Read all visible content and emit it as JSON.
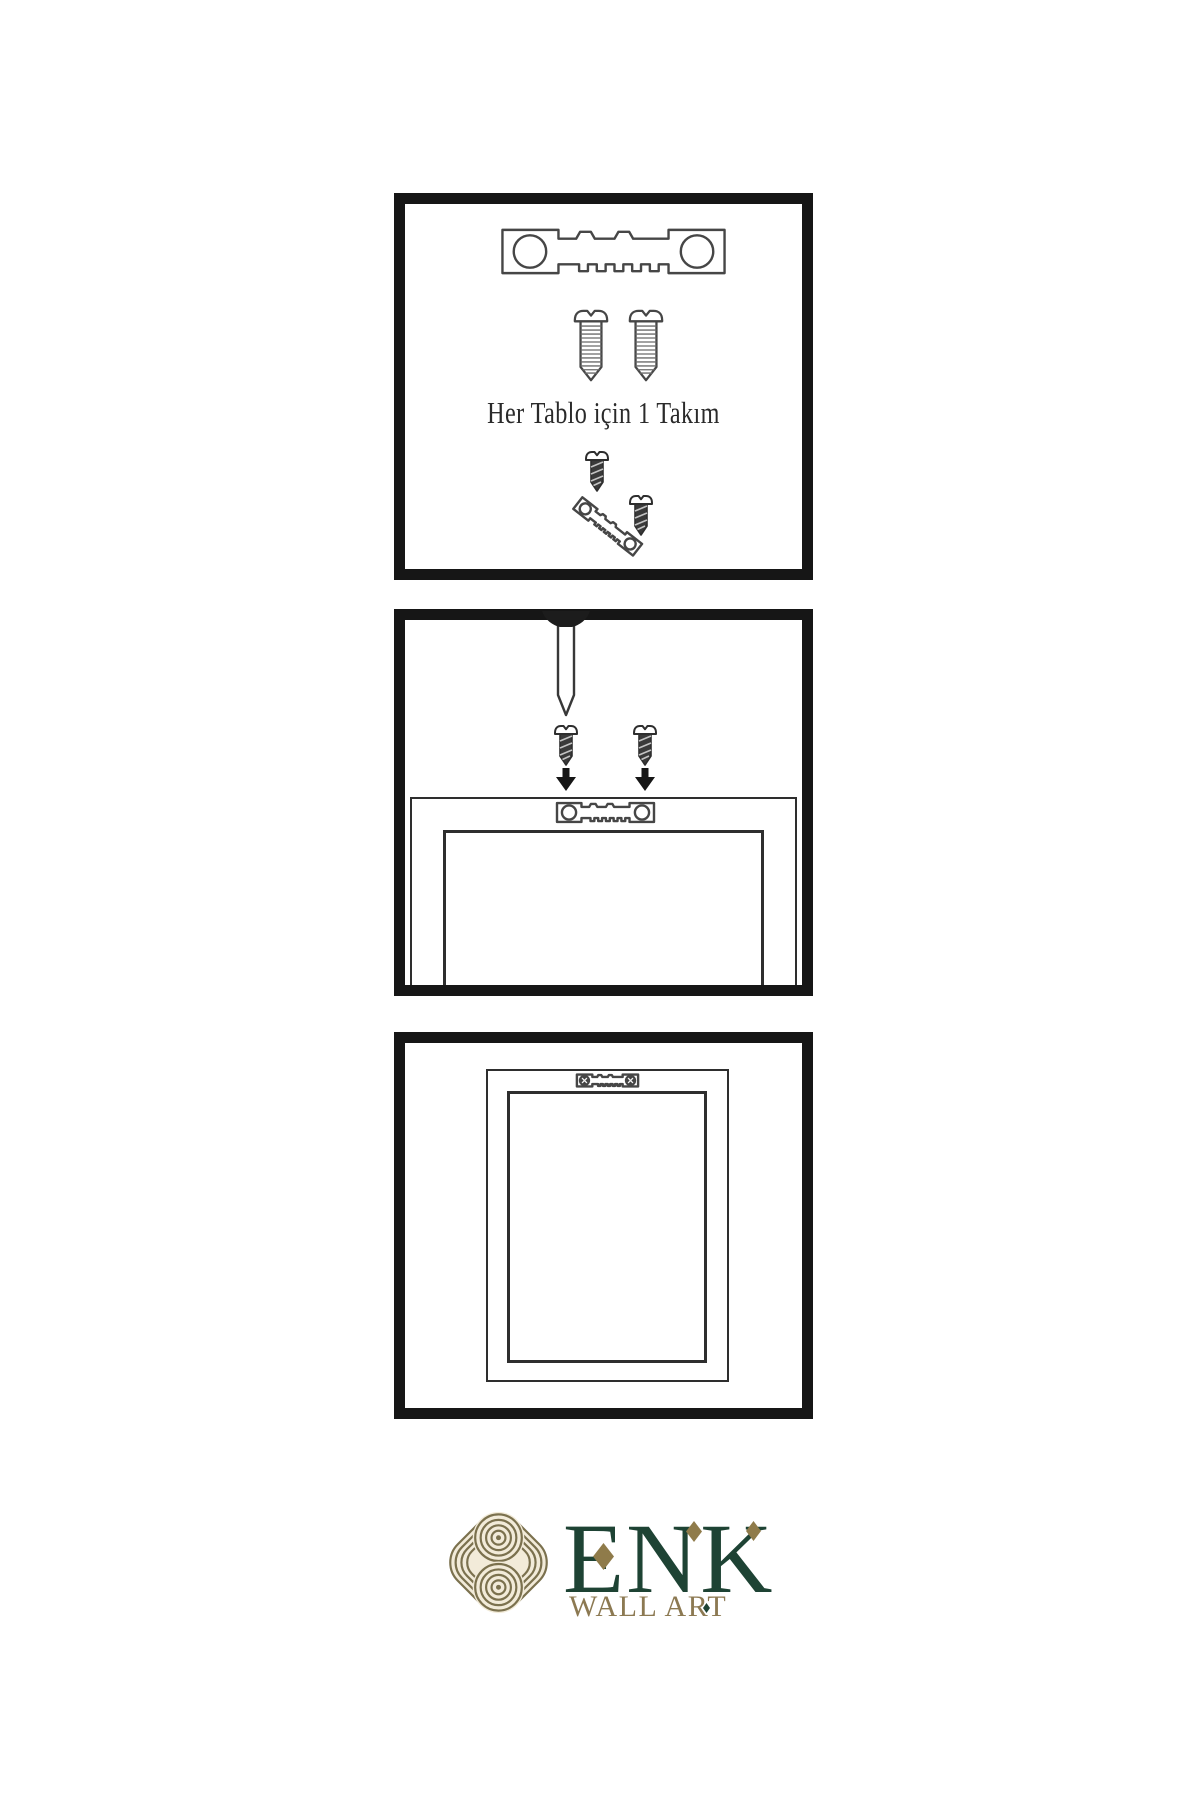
{
  "page": {
    "background": "#ffffff"
  },
  "instructions": {
    "panel1": {
      "caption": "Her Tablo için 1 Takım",
      "icons": [
        "sawtooth-hanger",
        "screw",
        "screw",
        "hanger-screws-assembly"
      ]
    },
    "panel2": {
      "icons": [
        "wall-nail",
        "screw-with-down-arrow",
        "screw-with-down-arrow",
        "frame-back-top",
        "sawtooth-hanger"
      ]
    },
    "panel3": {
      "icons": [
        "frame-back",
        "mounted-sawtooth-hanger"
      ]
    }
  },
  "brand": {
    "name": "ENK",
    "tagline": "WALL ART"
  },
  "palette": {
    "panel_border": "#161616",
    "outline": "#414141",
    "ink": "#1a1a1a",
    "caption_text": "#2a2a2a",
    "brand_green": "#1e4334",
    "brand_gold": "#8f7b4a",
    "knot_gold": "#7b714e",
    "knot_cream": "#f2ebd9"
  }
}
